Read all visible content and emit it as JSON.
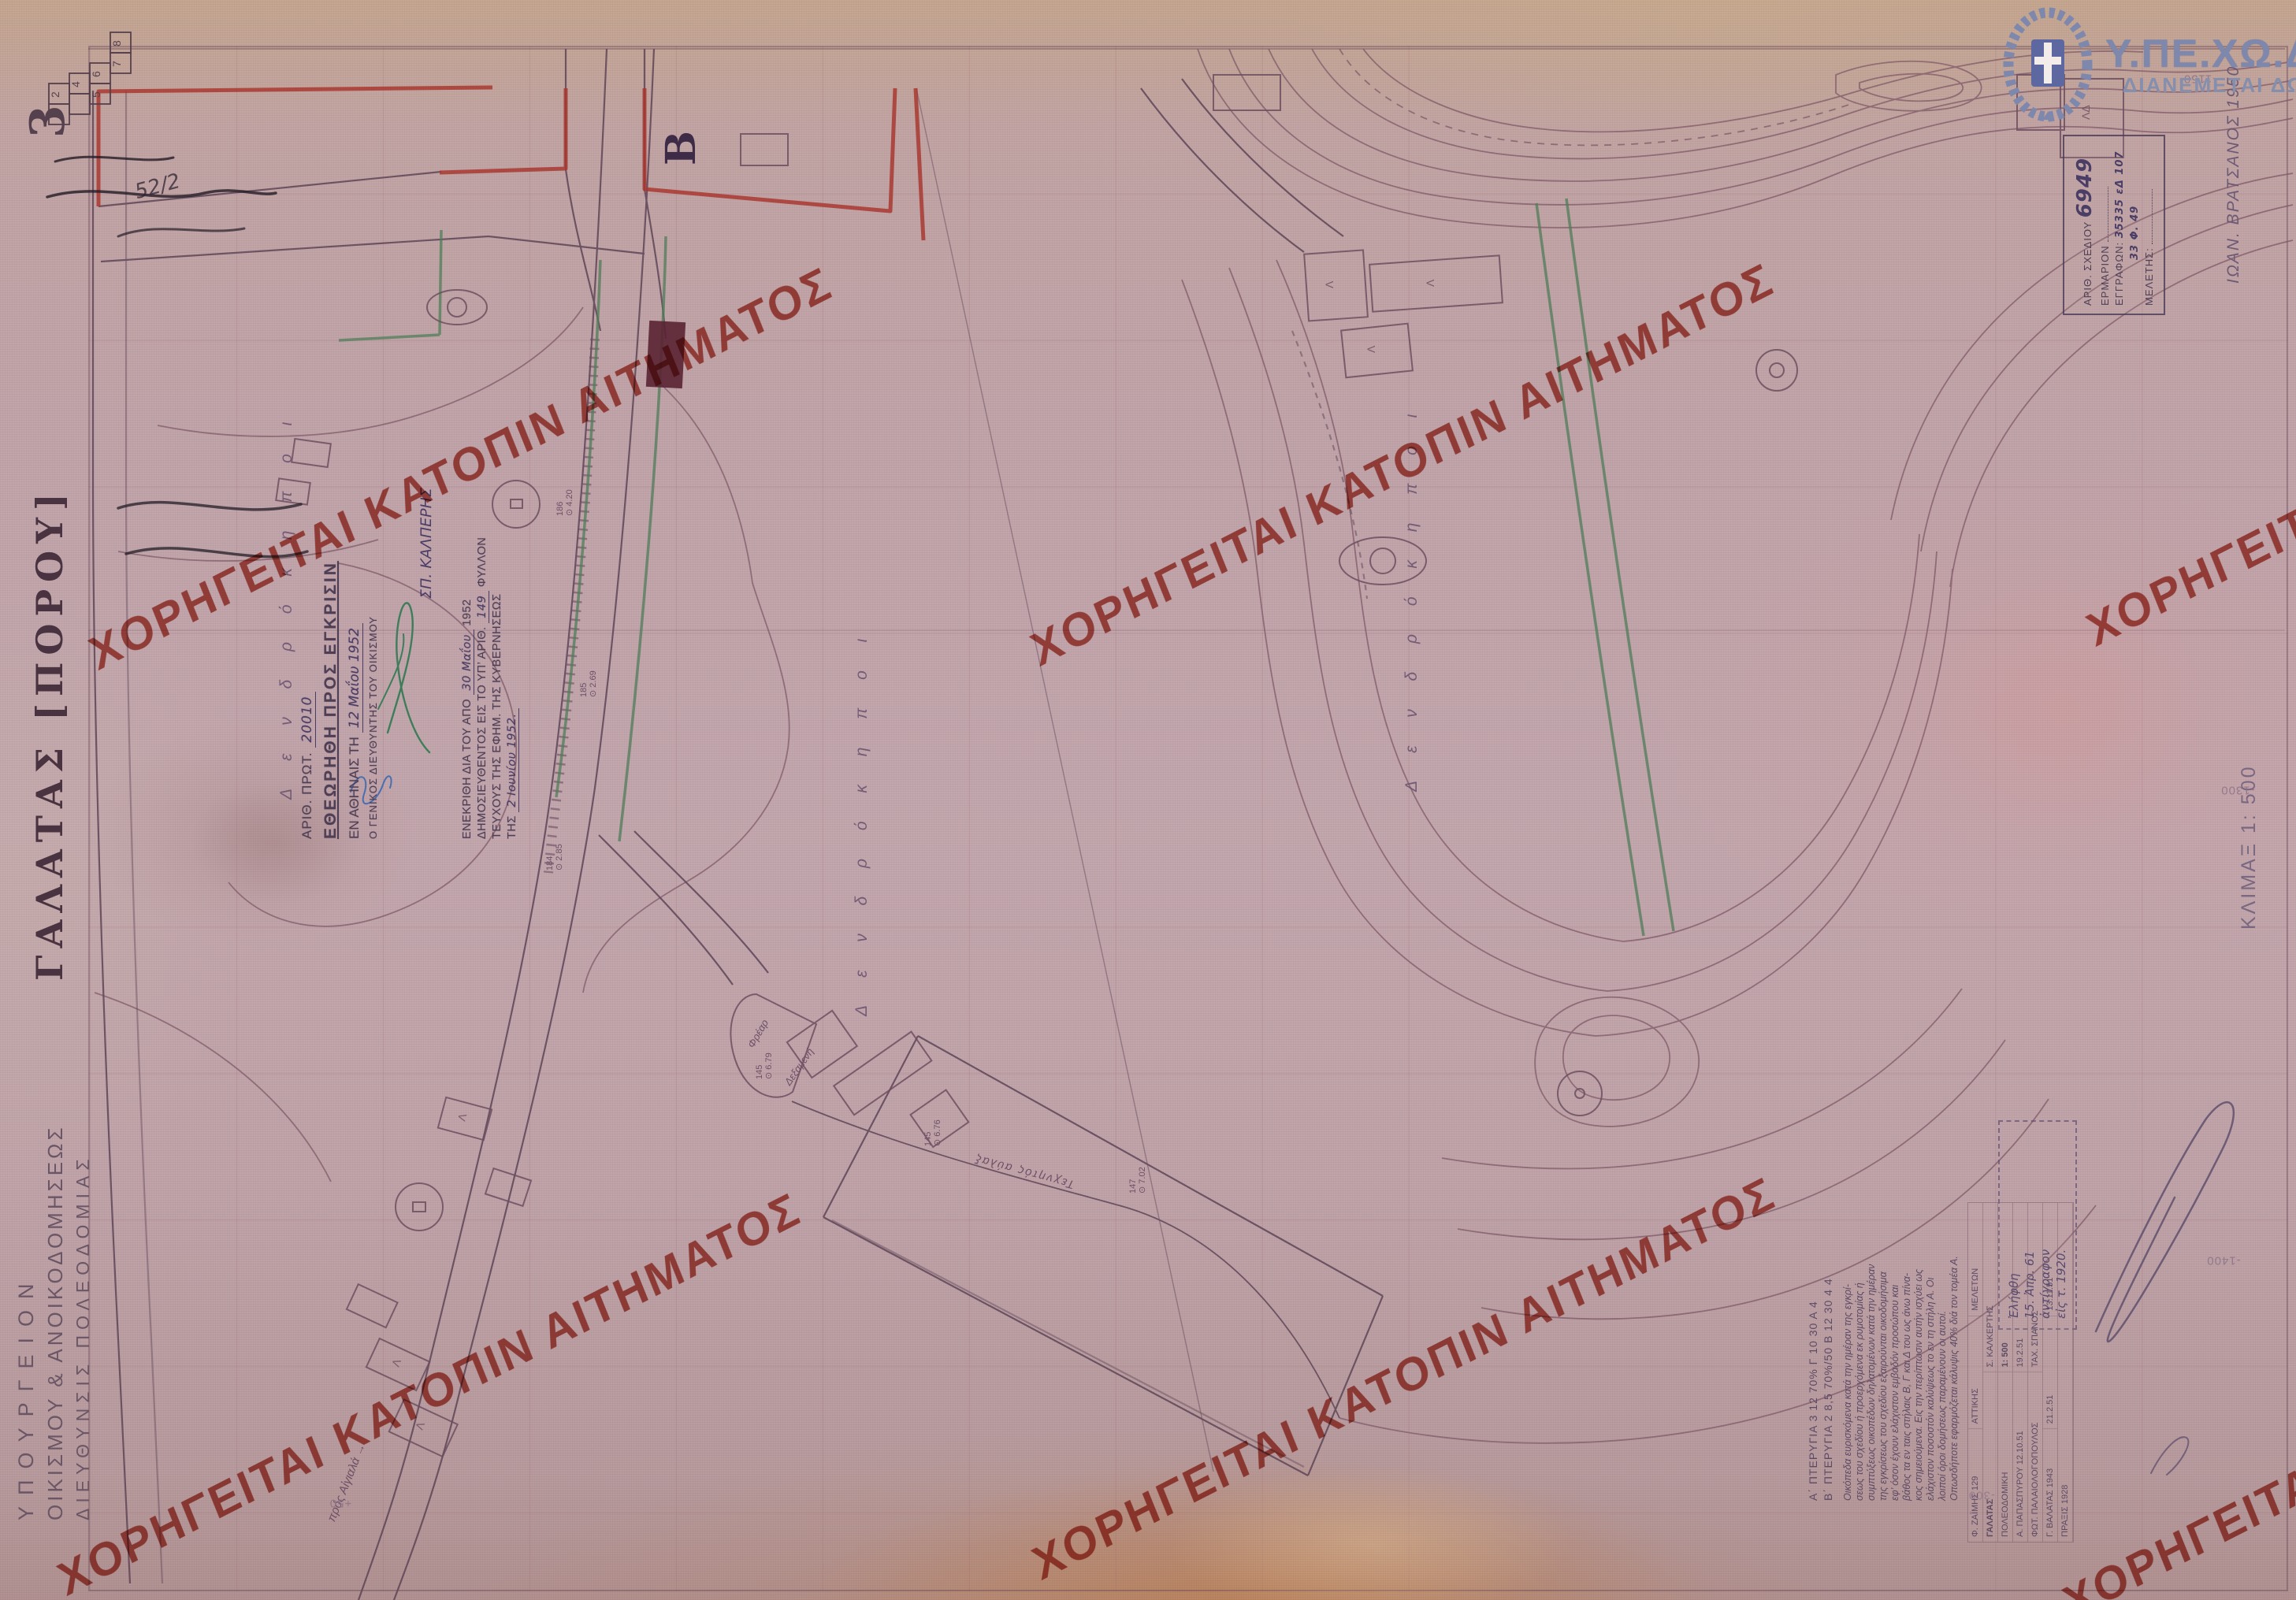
{
  "watermark": {
    "text": "ΧΟΡΗΓΕΙΤΑΙ ΚΑΤΟΠΙΝ ΑΙΤΗΜΑΤΟΣ",
    "color": "#b23427"
  },
  "logo": {
    "agency": "Υ.ΠΕ.ΧΩ.Δ.Ε.",
    "note": "ΔΙΑΝΕΜΕΤΑΙ ΔΩΡΕΑΝ"
  },
  "archive_stamp": {
    "field1": "ΑΡΙΘ. ΣΧΕΔΙΟΥ",
    "number": "6949",
    "field2": "ΕΡΜΑΡΙΟΝ",
    "field3": "ΕΓΓΡΑΦΩΝ:",
    "value3": "35335 εΔ 107",
    "value3b": "33  Φ. 49",
    "field4": "ΜΕΛΕΤΗΣ:"
  },
  "surveyor_note": "ΙΩΑΝ. ΒΡΑΤΣΑΝΟΣ 1950",
  "sheet_index": {
    "current": "3",
    "squares": [
      "1",
      "2",
      "3",
      "4",
      "5",
      "6",
      "7",
      "8"
    ],
    "pencil_note": "52/2"
  },
  "margin": {
    "ministry": "ΥΠΟΥΡΓΕΙΟΝ",
    "department": "ΟΙΚΙΣΜΟΥ & ΑΝΟΙΚΟΔΟΜΗΣΕΩΣ",
    "division": "ΔΙΕΥΘΥΝΣΙΣ  ΠΟΛΕΟΔΟΜΙΑΣ",
    "map_title": "ΓΑΛΑΤΑΣ [ΠΟΡΟΥ]",
    "scale": "ΚΛΙΜΑΞ 1: 500"
  },
  "approval_stamp": {
    "l1": "ΑΡΙΘ. ΠΡΩΤ.",
    "v1": "20010",
    "l2": "ΕΘΕΩΡΗΘΗ ΠΡΟΣ ΕΓΚΡΙΣΙΝ",
    "l3": "ΕΝ ΑΘΗΝΑΙΣ ΤΗ",
    "v3": "12 Μαΐου 1952",
    "l4": "Ο ΓΕΝΙΚΟΣ ΔΙΕΥΘΥΝΤΗΣ ΤΟΥ ΟΙΚΙΣΜΟΥ"
  },
  "gazette_stamp": {
    "l1": "ΕΝΕΚΡΙΘΗ ΔΙΑ ΤΟΥ ΑΠΟ",
    "v1": "30 Μαΐου",
    "y1": "1952",
    "l2": "ΔΗΜΟΣΙΕΥΘΕΝΤΟΣ ΕΙΣ ΤΟ ΥΠ’ ΑΡΙΘ.",
    "v2": "149",
    "l2b": "ΦΥΛΛΟΝ",
    "l3": "ΤΕΥΧΟΥΣ ΤΗΣ ΕΦΗΜ. ΤΗΣ ΚΥΒΕΡΝΗΣΕΩΣ",
    "l4": "ΤΗΣ",
    "v4": "2 Ιουνίου 1952.",
    "signature_name": "ΣΠ. ΚΑΛΠΕΡΗΣ"
  },
  "grid_labels": {
    "g1": "-1150",
    "g2": "-1300",
    "g3": "-1400",
    "g4": "-300",
    "g5": "+50"
  },
  "map_labels": {
    "block": "B",
    "garden": "Δ ε ν δ ρ ό κ η π ο ι",
    "channel": "Τεχνητός αύλαξ",
    "shore": "πρός Αἰγιαλά →",
    "well": "Φρέαρ",
    "cistern": "Δεξαμενή",
    "bld": "Λ",
    "bld2": "ΛΔ"
  },
  "spots": [
    {
      "id": "186",
      "elev": "4.20"
    },
    {
      "id": "185",
      "elev": "2.69"
    },
    {
      "id": "184",
      "elev": "2.85"
    },
    {
      "id": "147",
      "elev": "7.02"
    },
    {
      "id": "145",
      "elev": "6.79"
    },
    {
      "id": "145",
      "elev": "6.76"
    }
  ],
  "received_stamp": {
    "l1": "Ἐλήφθη",
    "l2": "15. Ἀπρ. 61",
    "l3": "ἀντίγραφον",
    "l4": "εἰς τ. 1920."
  },
  "notes": {
    "h1": "Α΄ ΠΤΕΡΥΓΙΑ 3    12  70% Γ 10    30 Α 4",
    "h2": "Β΄ ΠΤΕΡΥΓΙΑ 2    8,5 70%/50 Β 12    30 4 4",
    "par": [
      "Οικόπεδα ευρισκόμενα κατά την ημέραν της εγκρί-",
      "σεως του σχεδίου ή προερχόμενα εκ ρυμοτομίας ή",
      "συμπτύξεως οικοπέδων δηλατομένων κατά την ημέραν",
      "της εγκρίσεως του σχεδίου εξαιρούνται οικοδομήσιμα",
      "εφ’ όσον έχουν ελάχιστον εμβαδόν προσώπου και",
      "βάθος τα εν ταις στήλαις Β, Γ και Δ του ως άνω πίνα-",
      "κος σημειούμενα. Εις την περίπτωσιν αυτήν ισχύει ως",
      "ελάχιστον ποσοστόν καλύψεως το εν τη στήλη Α. Οι",
      "λοιποί όροι δομήσεως παραμένουν οι αυτοί.",
      "Οπωσδήποτε εφαρμόζεται κάλυψις 40% διά τον τομέα Α."
    ]
  },
  "title_block": {
    "r1a": "Φ. ΖΑΪΜΗΣ 129",
    "r1b": "ΑΤΤΙΚΗΣ",
    "r1c": "ΜΕΛΕΤΩΝ",
    "r2a": "ΓΑΛΑΤΑΣ",
    "r2b": "Σ. ΚΑΛΚΕΡΤΗΣ",
    "r3a": "ΠΟΛΕΟΔΟΜΙΚΗ",
    "r3b": "1: 500",
    "r4a": "Α. ΠΑΠΑΣΠΥΡΟΥ  12.10.51",
    "r4b": "19.2.51",
    "r5a": "ΦΩΤ. ΠΑΛΑΙΟΛΟΓΟΠΟΥΛΟΣ",
    "r5b": "ΤΑΧ. ΣΠΑΝΟΣ",
    "r6a": "Γ. ΒΑΛΑΤΑΣ 1943",
    "r6b": "21.2.51",
    "r6c": "13.11.51",
    "r7": "ΠΡΑΞΙΣ 1928"
  }
}
